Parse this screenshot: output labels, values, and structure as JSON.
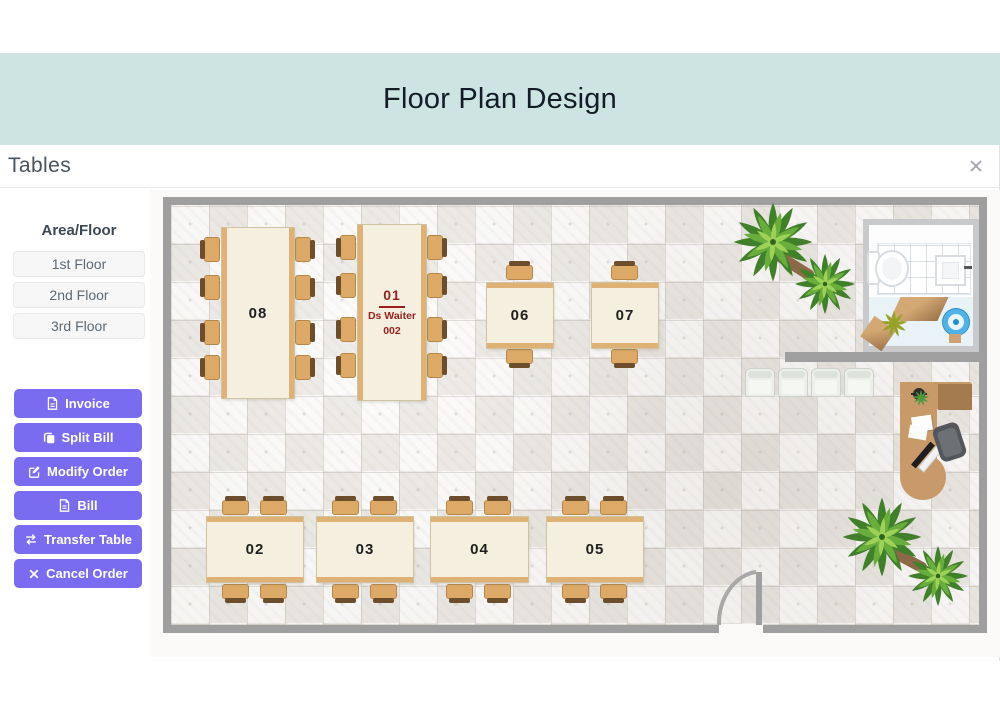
{
  "header": {
    "title": "Floor Plan Design"
  },
  "panel": {
    "title": "Tables",
    "close_icon": "x"
  },
  "sidebar": {
    "area_heading": "Area/Floor",
    "floors": [
      {
        "label": "1st Floor"
      },
      {
        "label": "2nd Floor"
      },
      {
        "label": "3rd Floor"
      }
    ],
    "actions": [
      {
        "label": "Invoice",
        "icon": "file-icon"
      },
      {
        "label": "Split Bill",
        "icon": "copy-icon"
      },
      {
        "label": "Modify Order",
        "icon": "edit-icon"
      },
      {
        "label": "Bill",
        "icon": "file-icon"
      },
      {
        "label": "Transfer Table",
        "icon": "transfer-arrows-icon"
      },
      {
        "label": "Cancel Order",
        "icon": "close-icon"
      }
    ]
  },
  "floor_plan": {
    "tables": [
      {
        "label": "01",
        "waiter": "Ds Waiter",
        "waiter_id": "002"
      },
      {
        "label": "02"
      },
      {
        "label": "03"
      },
      {
        "label": "04"
      },
      {
        "label": "05"
      },
      {
        "label": "06"
      },
      {
        "label": "07"
      },
      {
        "label": "08"
      }
    ]
  },
  "colors": {
    "banner_bg": "#cde4e2",
    "accent_purple": "#7a6cf0",
    "wall_gray": "#9f9f9f",
    "table_top": "#f4efdf",
    "table_trim": "#ddb274",
    "table_label_red": "#9b1f1f"
  }
}
